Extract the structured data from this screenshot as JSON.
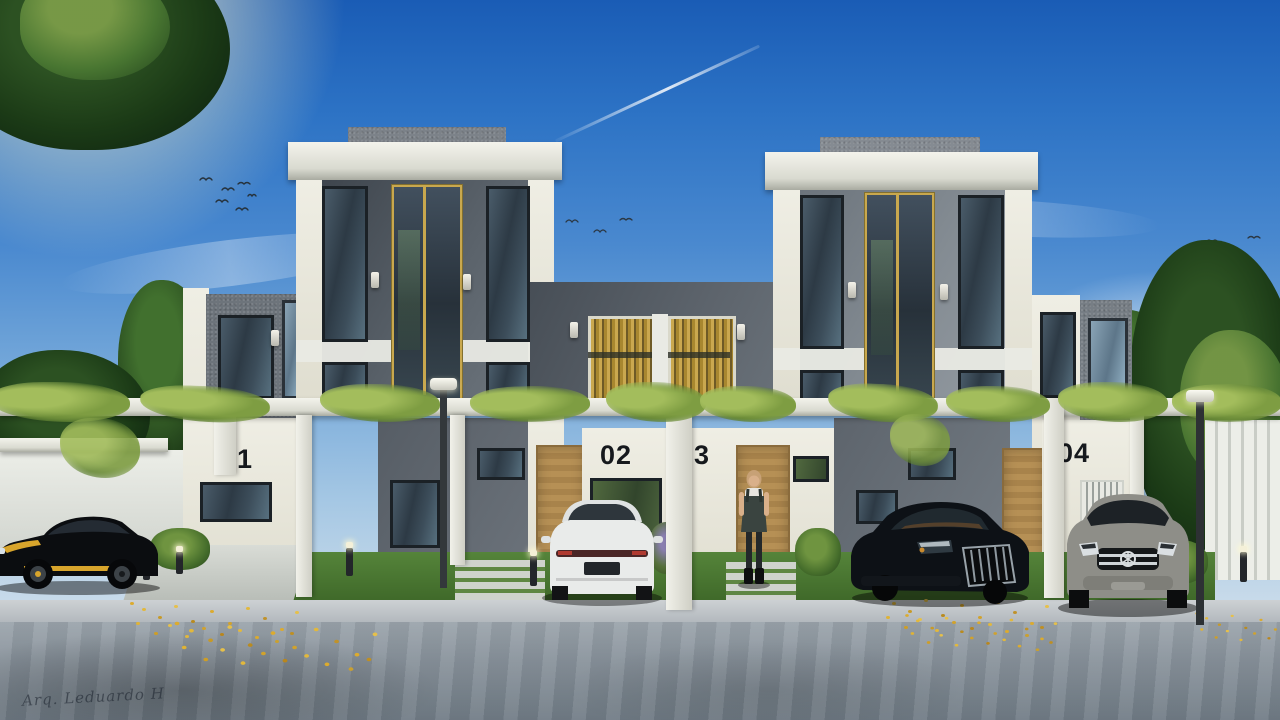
{
  "image": {
    "kind": "architectural-exterior-render",
    "title": "Modern two-tower townhouse complex with pergola, lawn and parked cars",
    "watermark": "Arq. Leduardo H",
    "units": [
      {
        "label": "01"
      },
      {
        "label": "02"
      },
      {
        "label": "3"
      },
      {
        "label": "04"
      }
    ],
    "palette": {
      "sky_top": "#1a5cb5",
      "sky_horizon": "#d7e2ec",
      "wall_cream": "#e9e7db",
      "wall_grey_dark": "#4a5158",
      "wall_grey_light": "#8b9299",
      "accent_gold": "#c9a84e",
      "pergola_white": "#e9eae4",
      "door_wood": "#b08d52",
      "grass_green": "#4d7c33",
      "vine_green": "#7e9d42",
      "road_grey": "#8b959e",
      "leaves_yellow": "#dcab2e"
    },
    "objects": {
      "cars": [
        "black-yellow muscle car",
        "white sedan rear",
        "dark sedan front",
        "grey suv front"
      ],
      "person": "woman standing at unit 3 door",
      "birds": "small flocks in sky",
      "contrail": "jet trail upper middle"
    }
  }
}
